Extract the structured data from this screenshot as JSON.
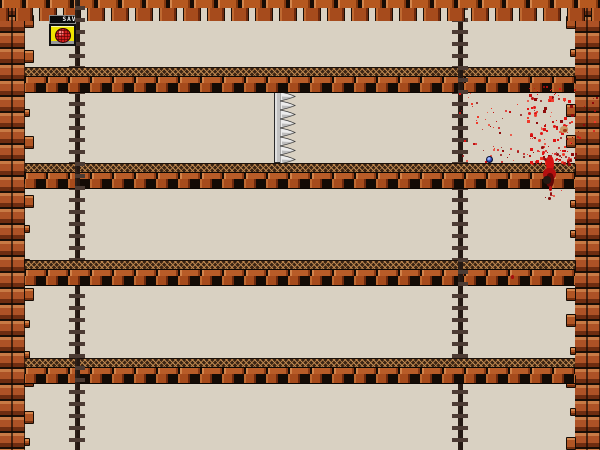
{
  "hud": {
    "save_sign_label": "SAVE"
  },
  "palette": {
    "background": "#d9d1c2",
    "brick_face": "#ad5226",
    "brick_light": "#c87a45",
    "brick_dark": "#6e2d11",
    "column_base": "#7b6b63",
    "blood_bright": "#e01414",
    "blood_dark": "#8f0b0b",
    "save_yellow": "#f0e400",
    "save_red": "#d32020"
  },
  "scene": {
    "viewport": {
      "w": 600,
      "h": 450
    },
    "top_border": {
      "x": 0,
      "y": 0,
      "w": 600,
      "h": 22
    },
    "walls": {
      "left": {
        "x": 0,
        "w": 25
      },
      "right": {
        "x": 575,
        "w": 25
      }
    },
    "platforms": [
      {
        "x": 25,
        "y": 67,
        "w": 550,
        "h": 27
      },
      {
        "x": 25,
        "y": 163,
        "w": 550,
        "h": 27
      },
      {
        "x": 25,
        "y": 260,
        "w": 550,
        "h": 27
      },
      {
        "x": 25,
        "y": 358,
        "w": 550,
        "h": 27
      }
    ],
    "column_pairs": [
      {
        "x": 75,
        "w": 68
      },
      {
        "x": 458,
        "w": 68
      }
    ],
    "column_front_patches": [
      {
        "pair": 0,
        "y": 0,
        "h": 22
      },
      {
        "pair": 0,
        "y": 163,
        "h": 27
      },
      {
        "pair": 0,
        "y": 358,
        "h": 27
      },
      {
        "pair": 1,
        "y": 67,
        "h": 27
      },
      {
        "pair": 1,
        "y": 260,
        "h": 27
      }
    ],
    "save_point": {
      "sign": {
        "x": 49,
        "y": 15,
        "w": 27,
        "h": 9
      },
      "button": {
        "x": 49,
        "y": 24,
        "w": 27,
        "h": 22
      }
    },
    "spike_trap": {
      "pole": {
        "x": 274,
        "y": 91,
        "w": 7,
        "h": 72
      },
      "teeth": {
        "count": 8,
        "len": 16,
        "h": 9
      }
    },
    "blood": {
      "clusters": [
        {
          "x": 527,
          "y": 86,
          "w": 48,
          "h": 78,
          "count": 120,
          "max": 3,
          "seed": 7
        },
        {
          "x": 458,
          "y": 92,
          "w": 69,
          "h": 70,
          "count": 40,
          "max": 2,
          "seed": 21
        },
        {
          "x": 576,
          "y": 90,
          "w": 21,
          "h": 48,
          "count": 14,
          "max": 2,
          "seed": 33
        },
        {
          "x": 492,
          "y": 148,
          "w": 36,
          "h": 15,
          "count": 14,
          "max": 2,
          "seed": 5
        },
        {
          "x": 530,
          "y": 150,
          "w": 46,
          "h": 13,
          "count": 42,
          "max": 3,
          "seed": 11
        },
        {
          "x": 536,
          "y": 186,
          "w": 26,
          "h": 12,
          "count": 6,
          "max": 2,
          "seed": 17
        }
      ],
      "speck_colors": [
        "#e01414",
        "#c01010",
        "#8f0b0b",
        "#f03a2a"
      ],
      "decals": [
        {
          "x": 546,
          "y": 156,
          "w": 8,
          "h": 16,
          "c": "#d81212"
        },
        {
          "x": 543,
          "y": 168,
          "w": 13,
          "h": 12,
          "c": "#b40f0f"
        },
        {
          "x": 546,
          "y": 173,
          "w": 8,
          "h": 14,
          "c": "#640707"
        },
        {
          "x": 543,
          "y": 176,
          "w": 8,
          "h": 8,
          "c": "#241812"
        },
        {
          "x": 549,
          "y": 186,
          "w": 3,
          "h": 5,
          "c": "#b01010"
        },
        {
          "x": 550,
          "y": 192,
          "w": 2,
          "h": 4,
          "c": "#930d0d"
        },
        {
          "x": 548,
          "y": 197,
          "w": 3,
          "h": 3,
          "c": "#7e0a0a"
        },
        {
          "x": 560,
          "y": 126,
          "w": 8,
          "h": 7,
          "c": "#c89a66"
        },
        {
          "x": 563,
          "y": 129,
          "w": 4,
          "h": 3,
          "c": "#a33714"
        },
        {
          "x": 511,
          "y": 275,
          "w": 3,
          "h": 4,
          "c": "#a80d0d"
        }
      ],
      "eye_gib": {
        "x": 486,
        "y": 156,
        "w": 7,
        "h": 7
      }
    }
  }
}
